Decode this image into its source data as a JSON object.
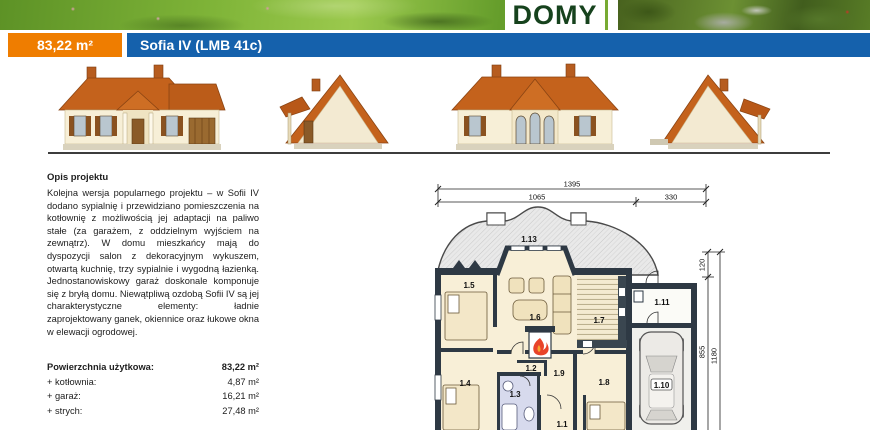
{
  "banner": {
    "logo_text": "DOMY"
  },
  "header": {
    "area_badge": "83,22 m²",
    "title": "Sofia IV (LMB 41c)",
    "accent_orange": "#ef7d00",
    "accent_blue": "#1561ac"
  },
  "description": {
    "heading": "Opis projektu",
    "body": "Kolejna wersja popularnego projektu – w Sofii IV dodano sypialnię i przewidziano pomieszczenia na kotłownię z możliwością jej adaptacji na paliwo stałe (za garażem, z oddzielnym wyjściem na zewnątrz). W domu mieszkańcy mają do dyspozycji salon z dekoracyjnym wykuszem, otwartą kuchnię, trzy sypialnie i wygodną łazienką. Jednostanowiskowy garaż doskonale komponuje się z bryłą domu. Niewątpliwą ozdobą Sofii IV są jej charakterystyczne elementy: ładnie zaprojektowany ganek, okiennice oraz łukowe okna w elewacji ogrodowej."
  },
  "areas": {
    "rows": [
      {
        "label": "Powierzchnia użytkowa:",
        "value": "83,22 m²"
      },
      {
        "label": "+ kotłownia:",
        "value": "4,87 m²"
      },
      {
        "label": "+ garaż:",
        "value": "16,21 m²"
      },
      {
        "label": "+ strych:",
        "value": "27,48 m²"
      }
    ],
    "kubatura_label": "Kubatura:",
    "kubatura_value": "534,00 m³"
  },
  "floorplan": {
    "dims": {
      "total_width": "1395",
      "width_main": "1065",
      "width_garage": "330",
      "d120": "120",
      "d855": "855",
      "d1180": "1180"
    },
    "rooms": {
      "r11": "1.1",
      "r12": "1.2",
      "r13": "1.3",
      "r14": "1.4",
      "r15": "1.5",
      "r16": "1.6",
      "r17": "1.7",
      "r18": "1.8",
      "r19": "1.9",
      "r110": "1.10",
      "r111": "1.11",
      "r113": "1.13"
    }
  }
}
